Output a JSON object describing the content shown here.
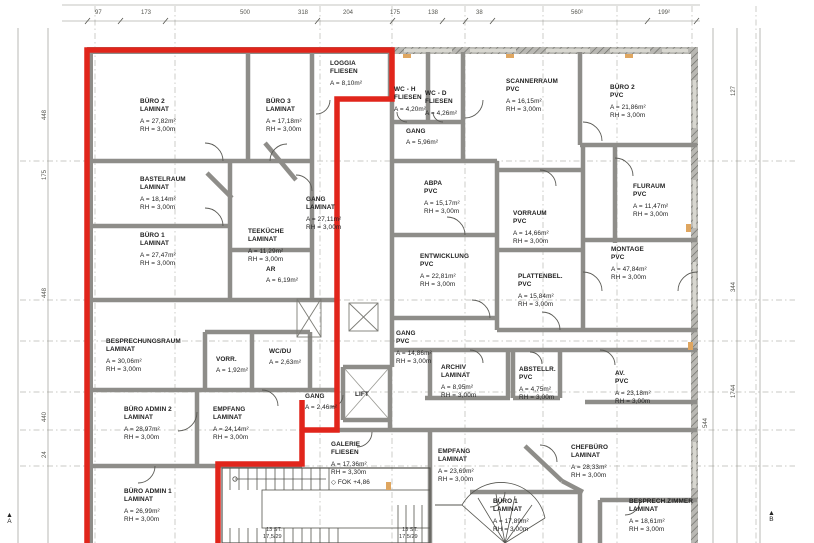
{
  "sheet": {
    "kind": "architectural floor plan",
    "unit_highlight": "red outline"
  },
  "colors": {
    "outline": "#e1251b",
    "wall": "#8e8d89",
    "line": "#4a4a4a",
    "dash": "#a9a9a2",
    "accent": "#dfa660",
    "paper": "#ffffff"
  },
  "rooms": [
    {
      "n": "BÜRO 2",
      "f": "LAMINAT",
      "a": "A = 27,82m²",
      "h": "RH = 3,00m",
      "x": 140,
      "y": 98
    },
    {
      "n": "BÜRO 3",
      "f": "LAMINAT",
      "a": "A = 17,18m²",
      "h": "RH = 3,00m",
      "x": 266,
      "y": 98
    },
    {
      "n": "LOGGIA",
      "f": "FLIESEN",
      "a": "A = 8,10m²",
      "h": "",
      "x": 330,
      "y": 60
    },
    {
      "n": "BASTELRAUM",
      "f": "LAMINAT",
      "a": "A = 18,14m²",
      "h": "RH = 3,00m",
      "x": 140,
      "y": 176
    },
    {
      "n": "BÜRO 1",
      "f": "LAMINAT",
      "a": "A = 27,47m²",
      "h": "RH = 3,00m",
      "x": 140,
      "y": 232
    },
    {
      "n": "TEEKÜCHE",
      "f": "LAMINAT",
      "a": "A = 11,29m²",
      "h": "RH = 3,00m",
      "x": 248,
      "y": 228
    },
    {
      "n": "AR",
      "f": "",
      "a": "A = 6,19m²",
      "h": "",
      "x": 266,
      "y": 266
    },
    {
      "n": "GANG",
      "f": "LAMINAT",
      "a": "A = 27,11m²",
      "h": "RH = 3,00m",
      "x": 306,
      "y": 196
    },
    {
      "n": "BESPRECHUNGSRAUM",
      "f": "LAMINAT",
      "a": "A = 30,06m²",
      "h": "RH = 3,00m",
      "x": 106,
      "y": 338
    },
    {
      "n": "VORR.",
      "f": "",
      "a": "A = 1,92m²",
      "h": "",
      "x": 216,
      "y": 356
    },
    {
      "n": "WC/DU",
      "f": "",
      "a": "A = 2,63m²",
      "h": "",
      "x": 269,
      "y": 348
    },
    {
      "n": "BÜRO ADMIN 2",
      "f": "LAMINAT",
      "a": "A = 28,97m²",
      "h": "RH = 3,00m",
      "x": 124,
      "y": 406
    },
    {
      "n": "EMPFANG",
      "f": "LAMINAT",
      "a": "A = 24,14m²",
      "h": "RH = 3,00m",
      "x": 213,
      "y": 406
    },
    {
      "n": "GANG",
      "f": "",
      "a": "A = 2,46m²",
      "h": "",
      "x": 305,
      "y": 393
    },
    {
      "n": "BÜRO ADMIN 1",
      "f": "LAMINAT",
      "a": "A = 26,99m²",
      "h": "RH = 3,00m",
      "x": 124,
      "y": 488
    },
    {
      "n": "WC - H",
      "f": "FLIESEN",
      "a": "A = 4,20m²",
      "h": "",
      "x": 394,
      "y": 86
    },
    {
      "n": "WC - D",
      "f": "FLIESEN",
      "a": "A = 4,26m²",
      "h": "",
      "x": 425,
      "y": 90
    },
    {
      "n": "GANG",
      "f": "",
      "a": "A = 5,96m²",
      "h": "",
      "x": 406,
      "y": 128
    },
    {
      "n": "SCANNERRAUM",
      "f": "PVC",
      "a": "A = 16,15m²",
      "h": "RH = 3,00m",
      "x": 506,
      "y": 78
    },
    {
      "n": "BÜRO 2",
      "f": "PVC",
      "a": "A = 21,86m²",
      "h": "RH = 3,00m",
      "x": 610,
      "y": 84
    },
    {
      "n": "ABPA",
      "f": "PVC",
      "a": "A = 15,17m²",
      "h": "RH = 3,00m",
      "x": 424,
      "y": 180
    },
    {
      "n": "VORRAUM",
      "f": "PVC",
      "a": "A = 14,66m²",
      "h": "RH = 3,00m",
      "x": 513,
      "y": 210
    },
    {
      "n": "FLURAUM",
      "f": "PVC",
      "a": "A = 11,47m²",
      "h": "RH = 3,00m",
      "x": 633,
      "y": 183
    },
    {
      "n": "ENTWICKLUNG",
      "f": "PVC",
      "a": "A = 22,81m²",
      "h": "RH = 3,00m",
      "x": 420,
      "y": 253
    },
    {
      "n": "PLATTENBEL.",
      "f": "PVC",
      "a": "A = 15,84m²",
      "h": "RH = 3,00m",
      "x": 518,
      "y": 273
    },
    {
      "n": "MONTAGE",
      "f": "PVC",
      "a": "A = 47,84m²",
      "h": "RH = 3,00m",
      "x": 611,
      "y": 246
    },
    {
      "n": "GANG",
      "f": "PVC",
      "a": "A = 14,86m²",
      "h": "RH = 3,00m",
      "x": 396,
      "y": 330
    },
    {
      "n": "ARCHIV",
      "f": "LAMINAT",
      "a": "A = 8,95m²",
      "h": "RH = 3,00m",
      "x": 441,
      "y": 364
    },
    {
      "n": "ABSTELLR.",
      "f": "PVC",
      "a": "A = 4,75m²",
      "h": "RH = 3,00m",
      "x": 519,
      "y": 366
    },
    {
      "n": "AV.",
      "f": "PVC",
      "a": "A = 23,18m²",
      "h": "RH = 3,00m",
      "x": 615,
      "y": 370
    },
    {
      "n": "LIFT",
      "f": "",
      "a": "",
      "h": "",
      "x": 355,
      "y": 391
    },
    {
      "n": "GALERIE",
      "f": "FLIESEN",
      "a": "A = 17,36m²",
      "h": "RH = 3,30m",
      "note": "◇ FOK +4,86",
      "x": 331,
      "y": 441
    },
    {
      "n": "EMPFANG",
      "f": "LAMINAT",
      "a": "A = 23,69m²",
      "h": "RH = 3,00m",
      "x": 438,
      "y": 448
    },
    {
      "n": "BÜRO 1",
      "f": "LAMINAT",
      "a": "A = 17,89m²",
      "h": "RH = 3,00m",
      "x": 493,
      "y": 498
    },
    {
      "n": "CHEFBÜRO",
      "f": "LAMINAT",
      "a": "A = 28,33m²",
      "h": "RH = 3,00m",
      "x": 571,
      "y": 444
    },
    {
      "n": "BESPRECH.ZIMMER",
      "f": "LAMINAT",
      "a": "A = 18,61m²",
      "h": "RH = 3,00m",
      "x": 629,
      "y": 498
    }
  ],
  "dims_top": [
    {
      "t": "97",
      "x": 95
    },
    {
      "t": "173",
      "x": 141
    },
    {
      "t": "500",
      "x": 240
    },
    {
      "t": "318",
      "x": 298
    },
    {
      "t": "204",
      "x": 343
    },
    {
      "t": "175",
      "x": 390
    },
    {
      "t": "138",
      "x": 428
    },
    {
      "t": "38",
      "x": 476
    },
    {
      "t": "560²",
      "x": 571
    },
    {
      "t": "199²",
      "x": 658
    }
  ],
  "dims_left": [
    {
      "t": "448",
      "y": 120
    },
    {
      "t": "175",
      "y": 180
    },
    {
      "t": "448",
      "y": 298
    },
    {
      "t": "440",
      "y": 422
    },
    {
      "t": "24",
      "y": 458
    }
  ],
  "dims_right": [
    {
      "t": "127",
      "x": 731,
      "y": 96
    },
    {
      "t": "344",
      "x": 731,
      "y": 292
    },
    {
      "t": "1744",
      "x": 731,
      "y": 398
    },
    {
      "t": "544",
      "x": 703,
      "y": 428
    }
  ],
  "stair_notes": [
    {
      "t": "13 ST.",
      "x": 266,
      "y": 527
    },
    {
      "t": "17,5/29",
      "x": 263,
      "y": 534
    },
    {
      "t": "13 ST.",
      "x": 402,
      "y": 527
    },
    {
      "t": "17,5/29",
      "x": 399,
      "y": 534
    }
  ],
  "markers": [
    {
      "letter": "A",
      "x": 6,
      "y": 512
    },
    {
      "letter": "B",
      "x": 768,
      "y": 510
    }
  ]
}
